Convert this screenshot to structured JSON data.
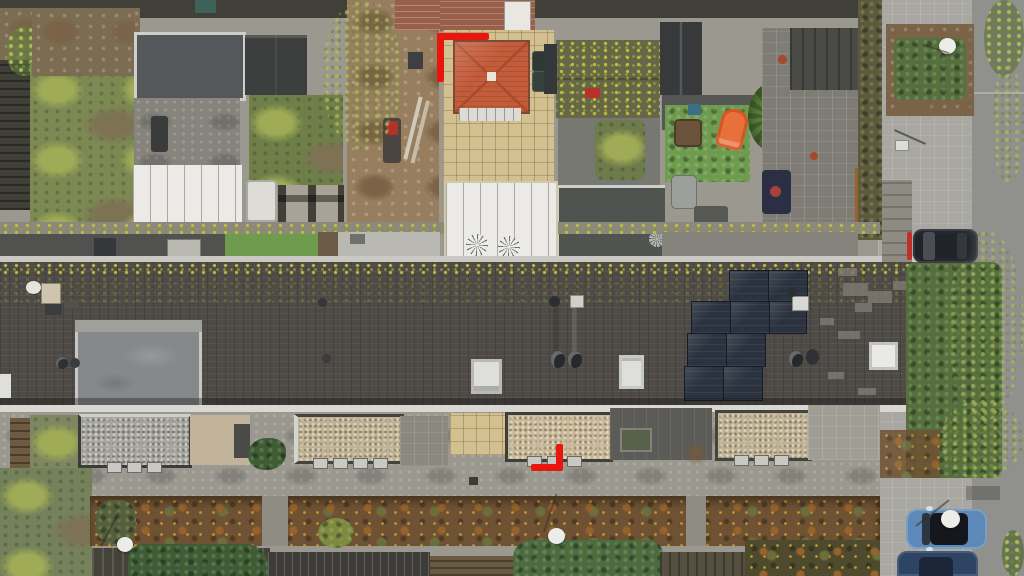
{
  "meta": {
    "title": "Aerial drone photo of terraced houses",
    "type": "top-down aerial photograph",
    "description": "Top-down drone photograph of a row of terraced houses: back gardens with sheds and patios at top, a long dark-tiled roof with solar panels and skylights across the middle, front gardens with autumn hedges below, and a street with parked cars on the right. Red corner brackets highlight one property."
  },
  "scene": {
    "highlight_markers": {
      "color": "#e8170e",
      "count": 2,
      "positions": [
        "top-left corner bracket at rear garden of highlighted house",
        "bottom-right corner bracket at front of highlighted house"
      ]
    },
    "main_roof": {
      "solar_panel_count": 9,
      "solar_rows": 4,
      "skylight_count": 4,
      "dormers": 2,
      "features": [
        "moss and lichen along ridge",
        "satellite dish",
        "chimney",
        "round vent pipes",
        "lighter replaced tile patches"
      ]
    },
    "back_gardens": [
      "patchy lawn garden with palm grass",
      "garden with flat-roof summer house and white ribbed canopy",
      "garden with dark shed, lawn and paved patio",
      "garden under construction with bare soil, ladder and machine",
      "highlighted garden with orange hip-roof outbuilding, beige tile patio, waste bins and white pergola with two fan awnings",
      "garden with mossy shed roof and garage",
      "garden with artificial turf, orange childrens slide, palm tree and storage box",
      "garden with stone patio, covered barbecue and rust-colored hedge"
    ],
    "front_area": [
      "gravel-covered bay window roofs",
      "beige tiled porch",
      "front path",
      "autumn hedge in brown, rust and olive tones",
      "green shrubs and conifer bushes",
      "three street lamps seen from above as white discs"
    ],
    "street": {
      "side": "right",
      "elements": [
        "paved sidewalk",
        "asphalt road",
        "green hedge block",
        "trees overhanging road"
      ],
      "vehicles": [
        {
          "name": "black car",
          "color": "#202329",
          "location": "parked upper right"
        },
        {
          "name": "light blue car with black glass roof",
          "color": "#5d89b8",
          "location": "parked lower right"
        },
        {
          "name": "dark blue car",
          "color": "#2e4464",
          "location": "parked bottom right, partially cropped"
        }
      ]
    }
  },
  "palette": {
    "ground_path": "#9b988f",
    "sidewalk": "#a8a7a1",
    "road": "#90918d",
    "roof_tile": "#4e4a45",
    "roof_tile_dark": "#423f3a",
    "moss_yellow": "#c1bc3c",
    "moss_green": "#8f9a3e",
    "gutter_white": "#d8d7d2",
    "dormer_gray": "#87888a",
    "dormer_light": "#9fa09c",
    "skylight_frame": "#dededb",
    "skylight_fill": "#b7bcbf",
    "solar_panel": "#2c3340",
    "solar_dark": "#161b24",
    "patch_light": "#7d786f",
    "orange_roof": "#c25c3a",
    "orange_roof_dark": "#a84a2c",
    "beige_tile": "#d2c091",
    "white_structure": "#ebeae6",
    "gray_canopy": "#8f9090",
    "garage_roof": "#4f5451",
    "shed_dark": "#3d3f3e",
    "shed_mossy": "#656748",
    "lawn_green": "#7c8953",
    "lawn_light": "#9fab56",
    "lawn_brown": "#7d7254",
    "turf_green": "#6f9b4e",
    "soil_brown": "#967e5e",
    "soil_dark": "#7a6347",
    "brush_brown": "#7c6c52",
    "fence_dark": "#403f38",
    "fence_brown": "#6d5a41",
    "wall_gray": "#8b887e",
    "pave_dark": "#5d5d59",
    "pave_gray": "#86847c",
    "gravel_gray": "#a5a49d",
    "gravel_tan": "#c0b292",
    "hedge_brown": "#6e5233",
    "hedge_rust": "#98622c",
    "hedge_olive": "#6d6e3e",
    "hedge_yellow": "#c29b31",
    "bush_green": "#55703c",
    "conifer_green": "#3f5d35",
    "deck_brown": "#6b5a42",
    "deck_dark": "#45423a",
    "marker_red": "#e8170e",
    "car_black": "#202329",
    "car_blue": "#5d89b8",
    "car_glass": "#15171c",
    "car_navy": "#2e4464",
    "lamp_white": "#ecece9",
    "brick_red": "#9a5f4a",
    "palm_green": "#5d7f3c",
    "slide_orange": "#e8703a",
    "bbq_navy": "#2a2f44"
  }
}
